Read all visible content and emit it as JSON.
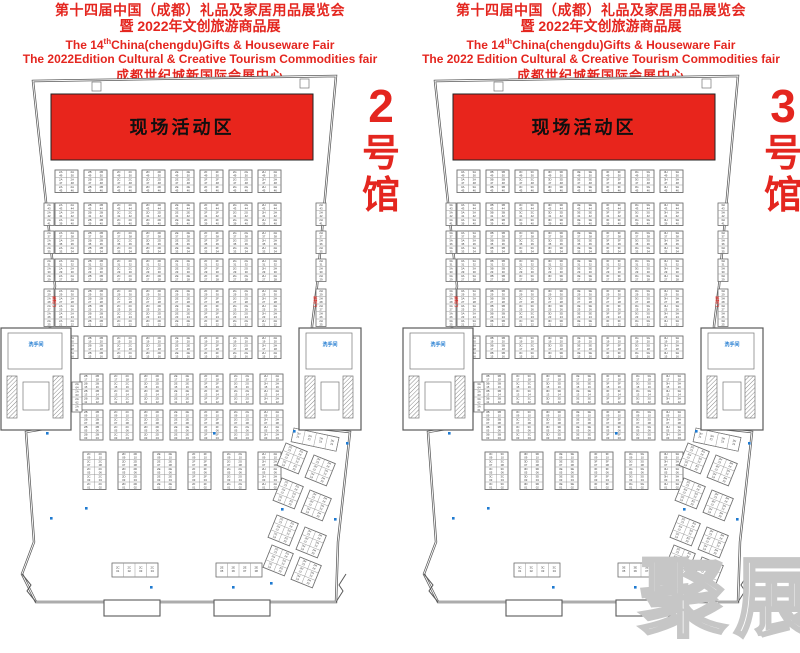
{
  "watermark": {
    "text": "聚展"
  },
  "colors": {
    "red": "#e4261f",
    "banner": "#e8251c",
    "wall": "#5a5a5a",
    "block_line": "#4a4a4a",
    "cell_line": "#9a9a9a",
    "cell_text": "#3a3a3a",
    "blue": "#1f7ad0"
  },
  "halls": [
    {
      "id": "hall-2",
      "number": "2",
      "label_chars": [
        "2",
        "号",
        "馆"
      ],
      "prefix": "2",
      "banner": "现场活动区",
      "restroom": "洗手间",
      "fire_exit": "消防门",
      "header": {
        "line1": "第十四届中国（成都）礼品及家居用品展览会",
        "line2": "暨 2022年文创旅游商品展",
        "l3a": "The 14",
        "l3sup": "th",
        "l3b": "China(chengdu)Gifts & Houseware Fair",
        "line4": "The 2022Edition Cultural & Creative Tourism Commodities fair",
        "line5": "成都世纪城新国际会展中心"
      }
    },
    {
      "id": "hall-3",
      "number": "3",
      "label_chars": [
        "3",
        "号",
        "馆"
      ],
      "prefix": "3",
      "banner": "现场活动区",
      "restroom": "洗手间",
      "fire_exit": "消防门",
      "header": {
        "line1": "第十四届中国（成都）礼品及家居用品展览会",
        "line2": "暨 2022年文创旅游商品展",
        "l3a": "The 14",
        "l3sup": "th",
        "l3b": "China(chengdu)Gifts & Houseware Fair",
        "line4": "The 2022 Edition Cultural & Creative Tourism Commodities fair",
        "line5": "成都世纪城新国际会展中心"
      }
    }
  ],
  "floorplan": {
    "outline": [
      [
        33,
        7
      ],
      [
        336,
        2
      ],
      [
        317,
        212
      ],
      [
        312,
        252
      ],
      [
        312,
        354
      ],
      [
        350,
        358
      ],
      [
        338,
        468
      ],
      [
        336,
        528
      ],
      [
        36,
        528
      ],
      [
        22,
        500
      ],
      [
        34,
        468
      ],
      [
        26,
        358
      ],
      [
        50,
        354
      ],
      [
        50,
        252
      ],
      [
        55,
        212
      ]
    ],
    "banner": {
      "x": 51,
      "y": 20,
      "w": 262,
      "h": 66
    },
    "letters8": [
      "A",
      "B",
      "C",
      "D",
      "E",
      "F",
      "G",
      "H"
    ],
    "letters7": [
      "B",
      "C",
      "D",
      "E",
      "F",
      "G",
      "H"
    ],
    "letters6": [
      "C",
      "D",
      "E",
      "F",
      "G",
      "H"
    ],
    "bands": [
      {
        "y": 96,
        "x0": 55,
        "cols": 8,
        "pitch": 29,
        "rows": 3,
        "start": 49,
        "side": false
      },
      {
        "y": 129,
        "x0": 55,
        "cols": 8,
        "pitch": 29,
        "rows": 3,
        "start": 43,
        "side": true
      },
      {
        "y": 157,
        "x0": 55,
        "cols": 8,
        "pitch": 29,
        "rows": 3,
        "start": 37,
        "side": true
      },
      {
        "y": 185,
        "x0": 55,
        "cols": 8,
        "pitch": 29,
        "rows": 3,
        "start": 31,
        "side": true
      },
      {
        "y": 215,
        "x0": 55,
        "cols": 8,
        "pitch": 29,
        "rows": 5,
        "start": 29,
        "side": true
      },
      {
        "y": 262,
        "x0": 55,
        "cols": 8,
        "pitch": 29,
        "rows": 3,
        "start": 19,
        "side": false
      },
      {
        "y": 300,
        "x0": 80,
        "cols": 7,
        "pitch": 30,
        "rows": 4,
        "start": 17,
        "side": false
      },
      {
        "y": 336,
        "x0": 80,
        "cols": 7,
        "pitch": 30,
        "rows": 4,
        "start": 9,
        "side": false
      },
      {
        "y": 378,
        "x0": 83,
        "cols": 6,
        "pitch": 35,
        "rows": 5,
        "start": 9,
        "side": false
      }
    ],
    "side_x": {
      "left": 44,
      "right": 316
    },
    "v_strips": [
      {
        "x": 72,
        "y": 308,
        "rows": 4,
        "letter": "A",
        "start": 64
      },
      {
        "x": 300,
        "y": 308,
        "rows": 4,
        "letter": "H",
        "start": 64
      }
    ],
    "bottom_strips": [
      {
        "x": 112,
        "y": 489,
        "cells": 4,
        "letter": "C",
        "start": 1,
        "deg": 0
      },
      {
        "x": 216,
        "y": 489,
        "cells": 4,
        "letter": "E",
        "start": 5,
        "deg": 0
      },
      {
        "x": 294,
        "y": 354,
        "cells": 4,
        "letter": "H",
        "start": 21,
        "deg": 12
      }
    ],
    "rotated": [
      {
        "x": 286,
        "y": 369
      },
      {
        "x": 314,
        "y": 381
      },
      {
        "x": 282,
        "y": 404
      },
      {
        "x": 310,
        "y": 416
      },
      {
        "x": 277,
        "y": 441
      },
      {
        "x": 305,
        "y": 453
      },
      {
        "x": 272,
        "y": 471
      },
      {
        "x": 300,
        "y": 483
      }
    ],
    "rot": {
      "deg": 22,
      "rows": 3,
      "start": 23,
      "letters": [
        "G",
        "H"
      ]
    },
    "structures": [
      {
        "x": 0,
        "y": 250,
        "w": 72,
        "h": 108
      },
      {
        "x": 298,
        "y": 250,
        "w": 64,
        "h": 108
      }
    ],
    "fire_labels": [
      [
        53,
        222
      ],
      [
        314,
        222
      ]
    ],
    "dots": [
      [
        46,
        358
      ],
      [
        213,
        358
      ],
      [
        50,
        443
      ],
      [
        85,
        433
      ],
      [
        293,
        356
      ],
      [
        346,
        368
      ],
      [
        281,
        434
      ],
      [
        334,
        444
      ],
      [
        270,
        508
      ],
      [
        150,
        512
      ],
      [
        232,
        512
      ]
    ],
    "porches": [
      [
        104,
        526,
        56,
        16
      ],
      [
        214,
        526,
        56,
        16
      ]
    ],
    "ticks": [
      [
        92,
        8
      ],
      [
        300,
        5
      ]
    ],
    "label_pos": {
      "x": 381,
      "ys": [
        48,
        92,
        134
      ],
      "sizes": [
        46,
        38,
        38
      ]
    }
  }
}
